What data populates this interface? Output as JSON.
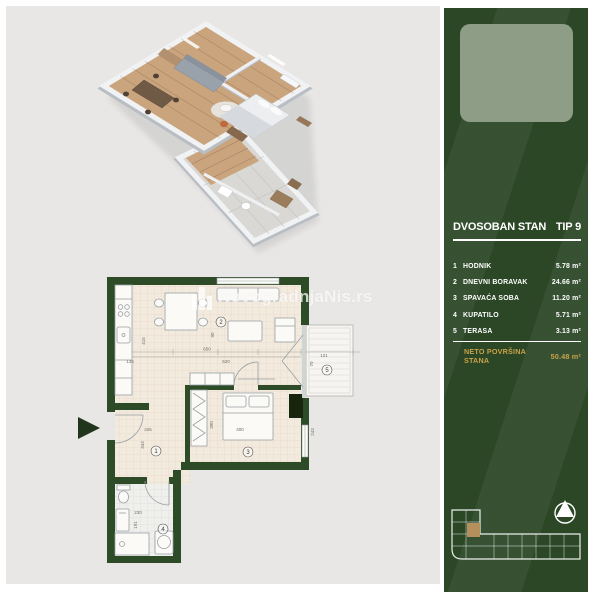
{
  "panel": {
    "title": "DVOSOBAN STAN",
    "type_label": "TIP 9",
    "rooms": [
      {
        "num": "1",
        "name": "HODNIK",
        "area": "5.78 m²"
      },
      {
        "num": "2",
        "name": "DNEVNI BORAVAK",
        "area": "24.66 m²"
      },
      {
        "num": "3",
        "name": "SPAVAĆA SOBA",
        "area": "11.20 m²"
      },
      {
        "num": "4",
        "name": "KUPATILO",
        "area": "5.71 m²"
      },
      {
        "num": "5",
        "name": "TERASA",
        "area": "3.13 m²"
      }
    ],
    "total_label": "NETO POVRŠINA STANA",
    "total_area": "50.48 m²",
    "colors": {
      "background": "#2b4726",
      "accent_gold": "#c9a24a",
      "logo_placeholder": "#8e9e86"
    }
  },
  "watermark": {
    "text": "NovogradnjaNis.rs"
  },
  "plan2d": {
    "wall_color": "#2d4b27",
    "dims": {
      "415": "415",
      "135": "135",
      "650": "650",
      "520": "520",
      "90": "90",
      "121": "121",
      "70": "70",
      "345": "345",
      "343": "343",
      "390": "390",
      "400": "400",
      "230": "230",
      "191": "191",
      "243": "243"
    }
  }
}
